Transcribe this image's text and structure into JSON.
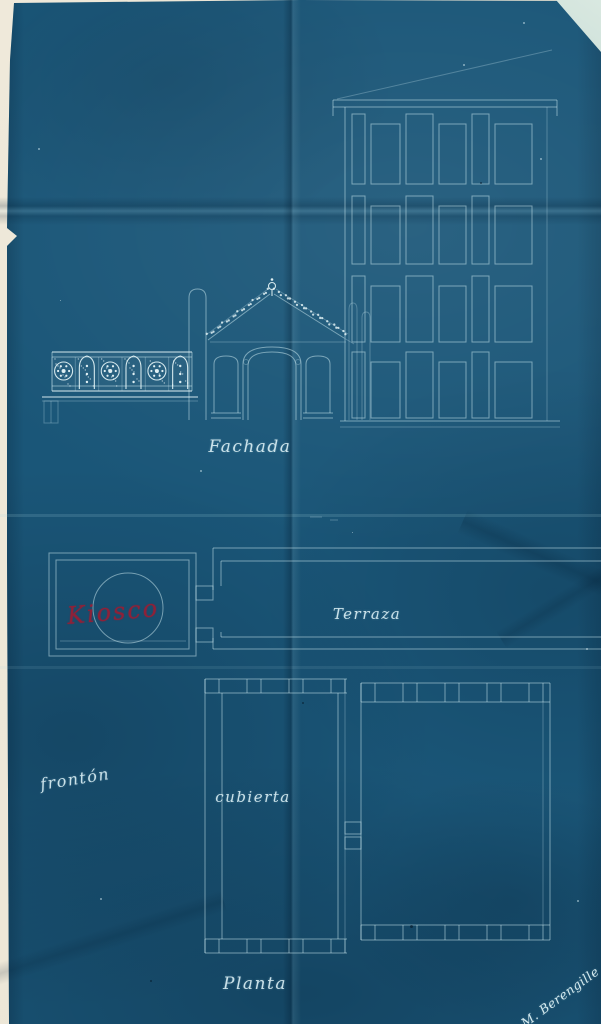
{
  "labels": {
    "fachada": "Fachada",
    "terraza": "Terraza",
    "kiosco": "Kiosco",
    "fronton": "frontón",
    "cubierta": "cubierta",
    "planta": "Planta",
    "signature": "M. Berengille"
  },
  "colors": {
    "paper_blue": "#1a5678",
    "paper_dark": "#123f5c",
    "line_white": "#cfe6ea",
    "ornament_white": "#ecfafc",
    "red_ink": "#8e2138",
    "backing_cream": "#ece6d6",
    "corner_fold": "#bcd7d2"
  }
}
